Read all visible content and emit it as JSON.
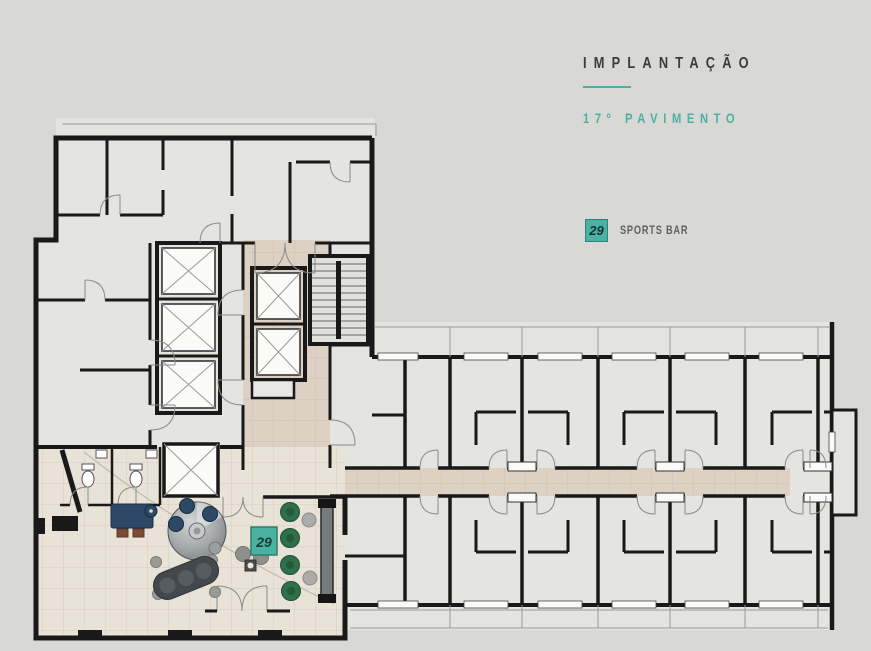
{
  "colors": {
    "background": "#d8d8d4",
    "accent_teal": "#49b2a3",
    "title_ink": "#3b3b3b",
    "label_ink": "#5f5f5f",
    "wall_ink": "#191919",
    "room_fill": "#e4e4e1",
    "corridor_tan": "#ddd1c3",
    "sportsbar_floor": "#e9e2d6",
    "navy_furniture": "#2d4965",
    "green_stool": "#2f6f49"
  },
  "panel": {
    "title": "IMPLANTAÇÃO",
    "subtitle": "17º PAVIMENTO",
    "legend": [
      {
        "number": "29",
        "label": "SPORTS BAR"
      }
    ]
  },
  "plan": {
    "marker": {
      "number": "29"
    }
  }
}
